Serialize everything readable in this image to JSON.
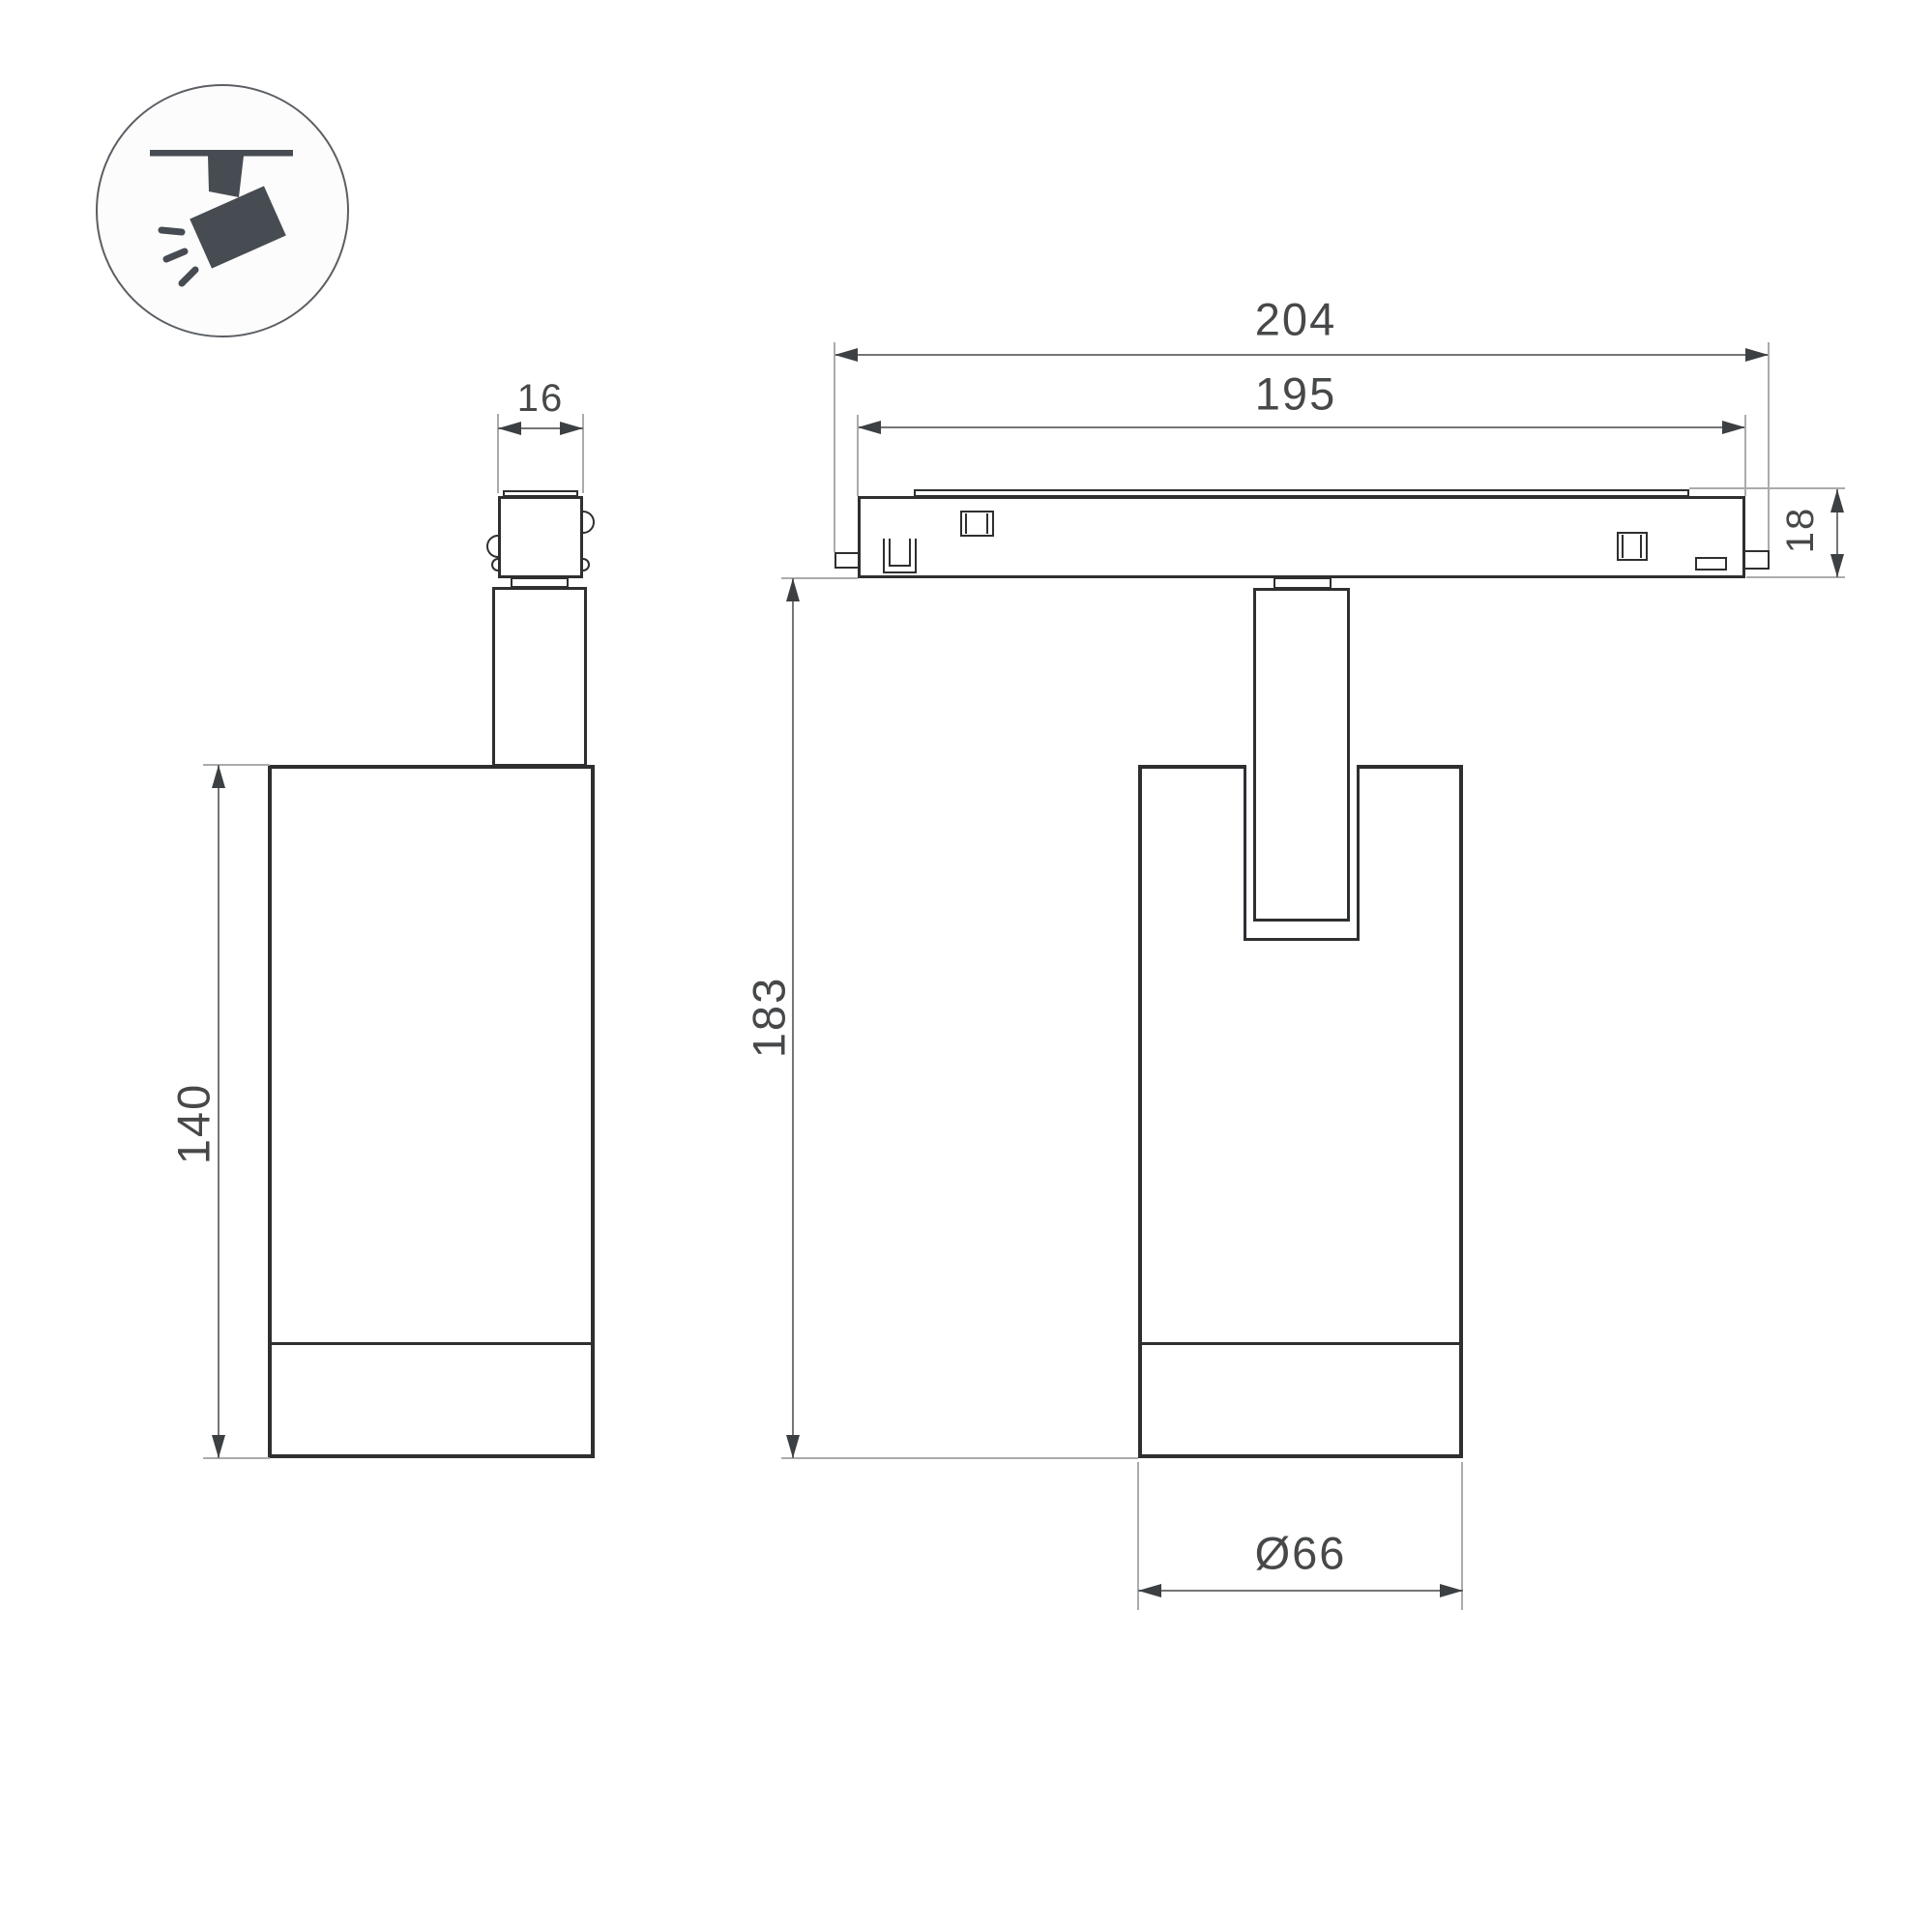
{
  "icon": {
    "name": "track-spotlight-pictogram",
    "fg": "#474c52",
    "circle_stroke": "#5b5f64",
    "circle_fill": "#fcfcfc"
  },
  "colors": {
    "outline": "#2d2f31",
    "dimension_line": "#757575",
    "extension_line": "#ababab",
    "arrow": "#3c4043",
    "text": "#46484a",
    "background": "#ffffff"
  },
  "views": {
    "side": {
      "name": "side-view",
      "dims": {
        "stem_width": "16",
        "body_height": "140"
      }
    },
    "front": {
      "name": "front-view-with-track",
      "dims": {
        "track_outer_length": "204",
        "track_inner_length": "195",
        "track_height": "18",
        "overall_height": "183",
        "body_diameter": "Ø66"
      }
    }
  }
}
